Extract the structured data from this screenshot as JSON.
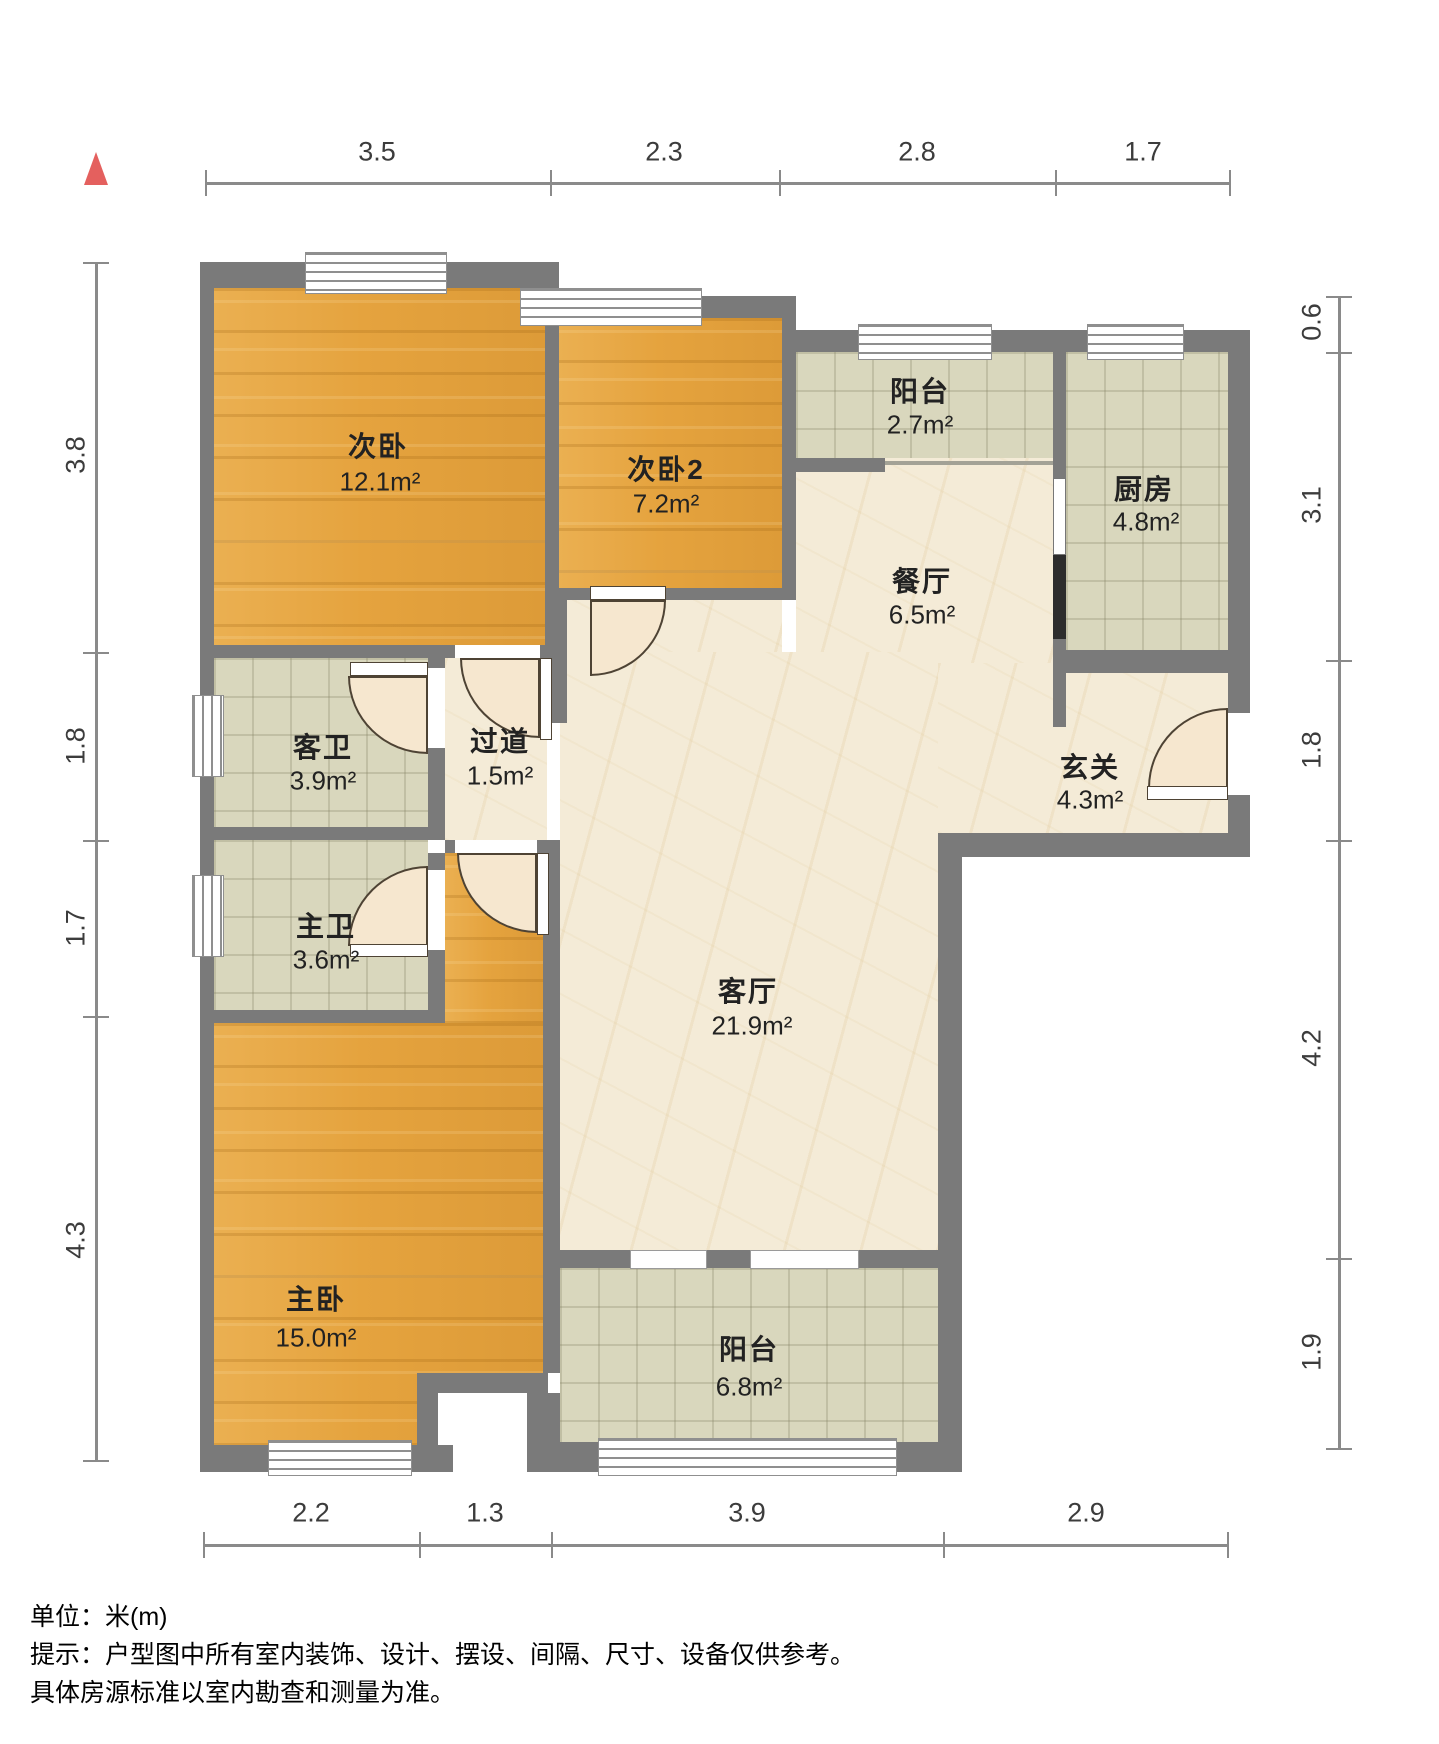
{
  "rooms": [
    {
      "id": "bedroom-2",
      "name": "次卧",
      "area": "12.1m²"
    },
    {
      "id": "bedroom-3",
      "name": "次卧2",
      "area": "7.2m²"
    },
    {
      "id": "balcony-top",
      "name": "阳台",
      "area": "2.7m²"
    },
    {
      "id": "kitchen",
      "name": "厨房",
      "area": "4.8m²"
    },
    {
      "id": "dining-room",
      "name": "餐厅",
      "area": "6.5m²"
    },
    {
      "id": "guest-bathroom",
      "name": "客卫",
      "area": "3.9m²"
    },
    {
      "id": "hallway",
      "name": "过道",
      "area": "1.5m²"
    },
    {
      "id": "foyer",
      "name": "玄关",
      "area": "4.3m²"
    },
    {
      "id": "master-bathroom",
      "name": "主卫",
      "area": "3.6m²"
    },
    {
      "id": "living-room",
      "name": "客厅",
      "area": "21.9m²"
    },
    {
      "id": "master-bedroom",
      "name": "主卧",
      "area": "15.0m²"
    },
    {
      "id": "balcony-bottom",
      "name": "阳台",
      "area": "6.8m²"
    }
  ],
  "dimensions": {
    "top": [
      "3.5",
      "2.3",
      "2.8",
      "1.7"
    ],
    "left": [
      "3.8",
      "1.8",
      "1.7",
      "4.3"
    ],
    "right": [
      "0.6",
      "3.1",
      "1.8",
      "4.2",
      "1.9"
    ],
    "bottom": [
      "2.2",
      "1.3",
      "3.9",
      "2.9"
    ]
  },
  "footer": {
    "unit_line": "单位：米(m)",
    "note_line1": "提示：户型图中所有室内装饰、设计、摆设、间隔、尺寸、设备仅供参考。",
    "note_line2": "具体房源标准以室内勘查和测量为准。"
  },
  "colors": {
    "wall": "#7a7a7a",
    "wood_floor": "#e5a33e",
    "tile_floor": "#d9d7bd",
    "marble_floor": "#f4ebd7",
    "north_arrow": "#e4605e"
  }
}
